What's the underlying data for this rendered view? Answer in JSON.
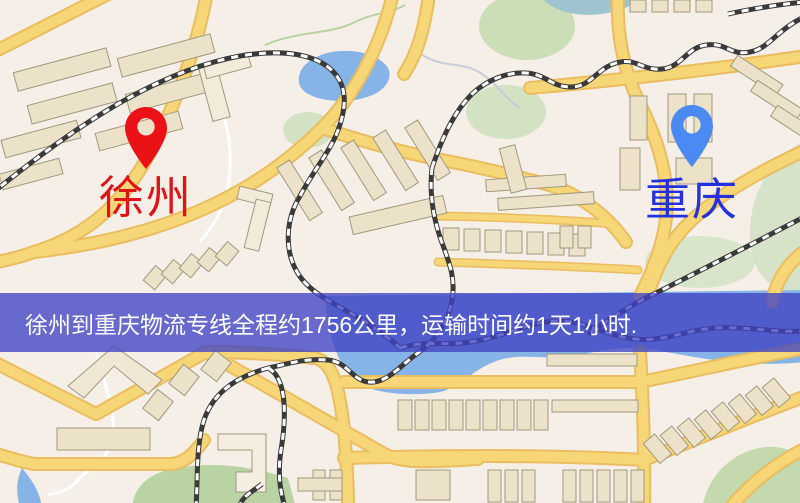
{
  "map": {
    "origin": {
      "label": "徐州",
      "pin_color": "#ea1216",
      "label_color": "#e01317"
    },
    "destination": {
      "label": "重庆",
      "pin_color": "#4b89f3",
      "label_color": "#2531dc"
    }
  },
  "banner": {
    "text": "徐州到重庆物流专线全程约1756公里，运输时间约1天1小时.",
    "background": "#4042c4",
    "text_color": "#ffffff"
  },
  "map_palette": {
    "land": "#f6efe8",
    "road": "#f6d676",
    "road_casing": "#e9bd60",
    "water": "#87b4e6",
    "park": "#c9dcb4",
    "building": "#ebe2c9",
    "railway": "#3a3a3a"
  }
}
